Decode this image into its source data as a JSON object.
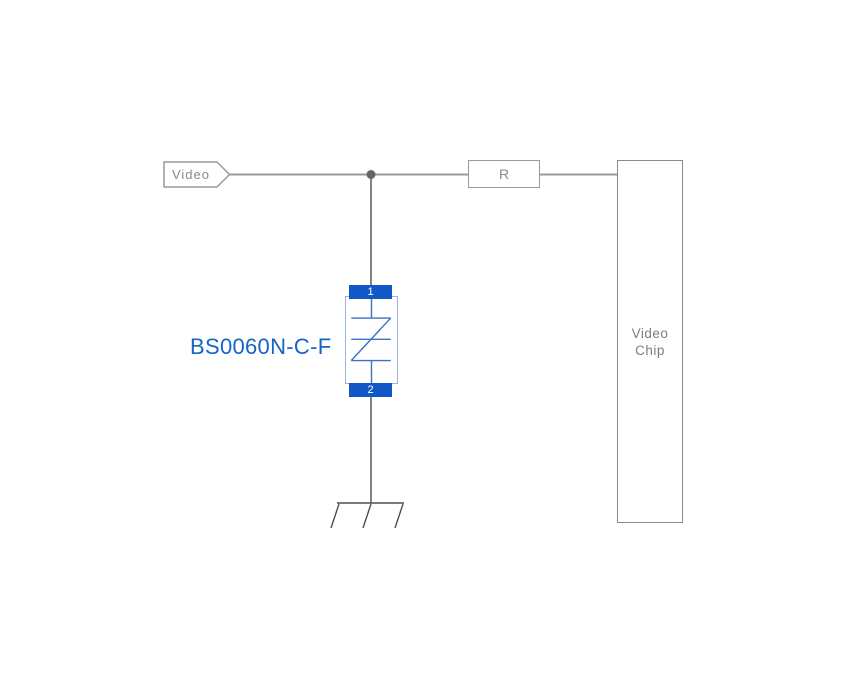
{
  "colors": {
    "accent_blue": "#1565c8",
    "pad_blue": "#1158c6",
    "tvs_symbol_blue": "#3f6fc8",
    "tvs_body_border": "#9ab5e0",
    "wire_gray": "#9a9a9a",
    "wire_dark": "#4d4d4d",
    "junction_gray": "#666666",
    "box_border_gray": "#9a9a9a",
    "chip_border_gray": "#8c8c8c",
    "label_gray": "#8a8a8a",
    "chip_text_gray": "#7d7d7d",
    "pad_text_white": "#ffffff"
  },
  "diagram": {
    "net_flag": {
      "label": "Video"
    },
    "resistor": {
      "label": "R"
    },
    "chip": {
      "label_line1": "Video",
      "label_line2": "Chip"
    },
    "tvs": {
      "part_number": "BS0060N-C-F",
      "pin1_label": "1",
      "pin2_label": "2"
    }
  }
}
